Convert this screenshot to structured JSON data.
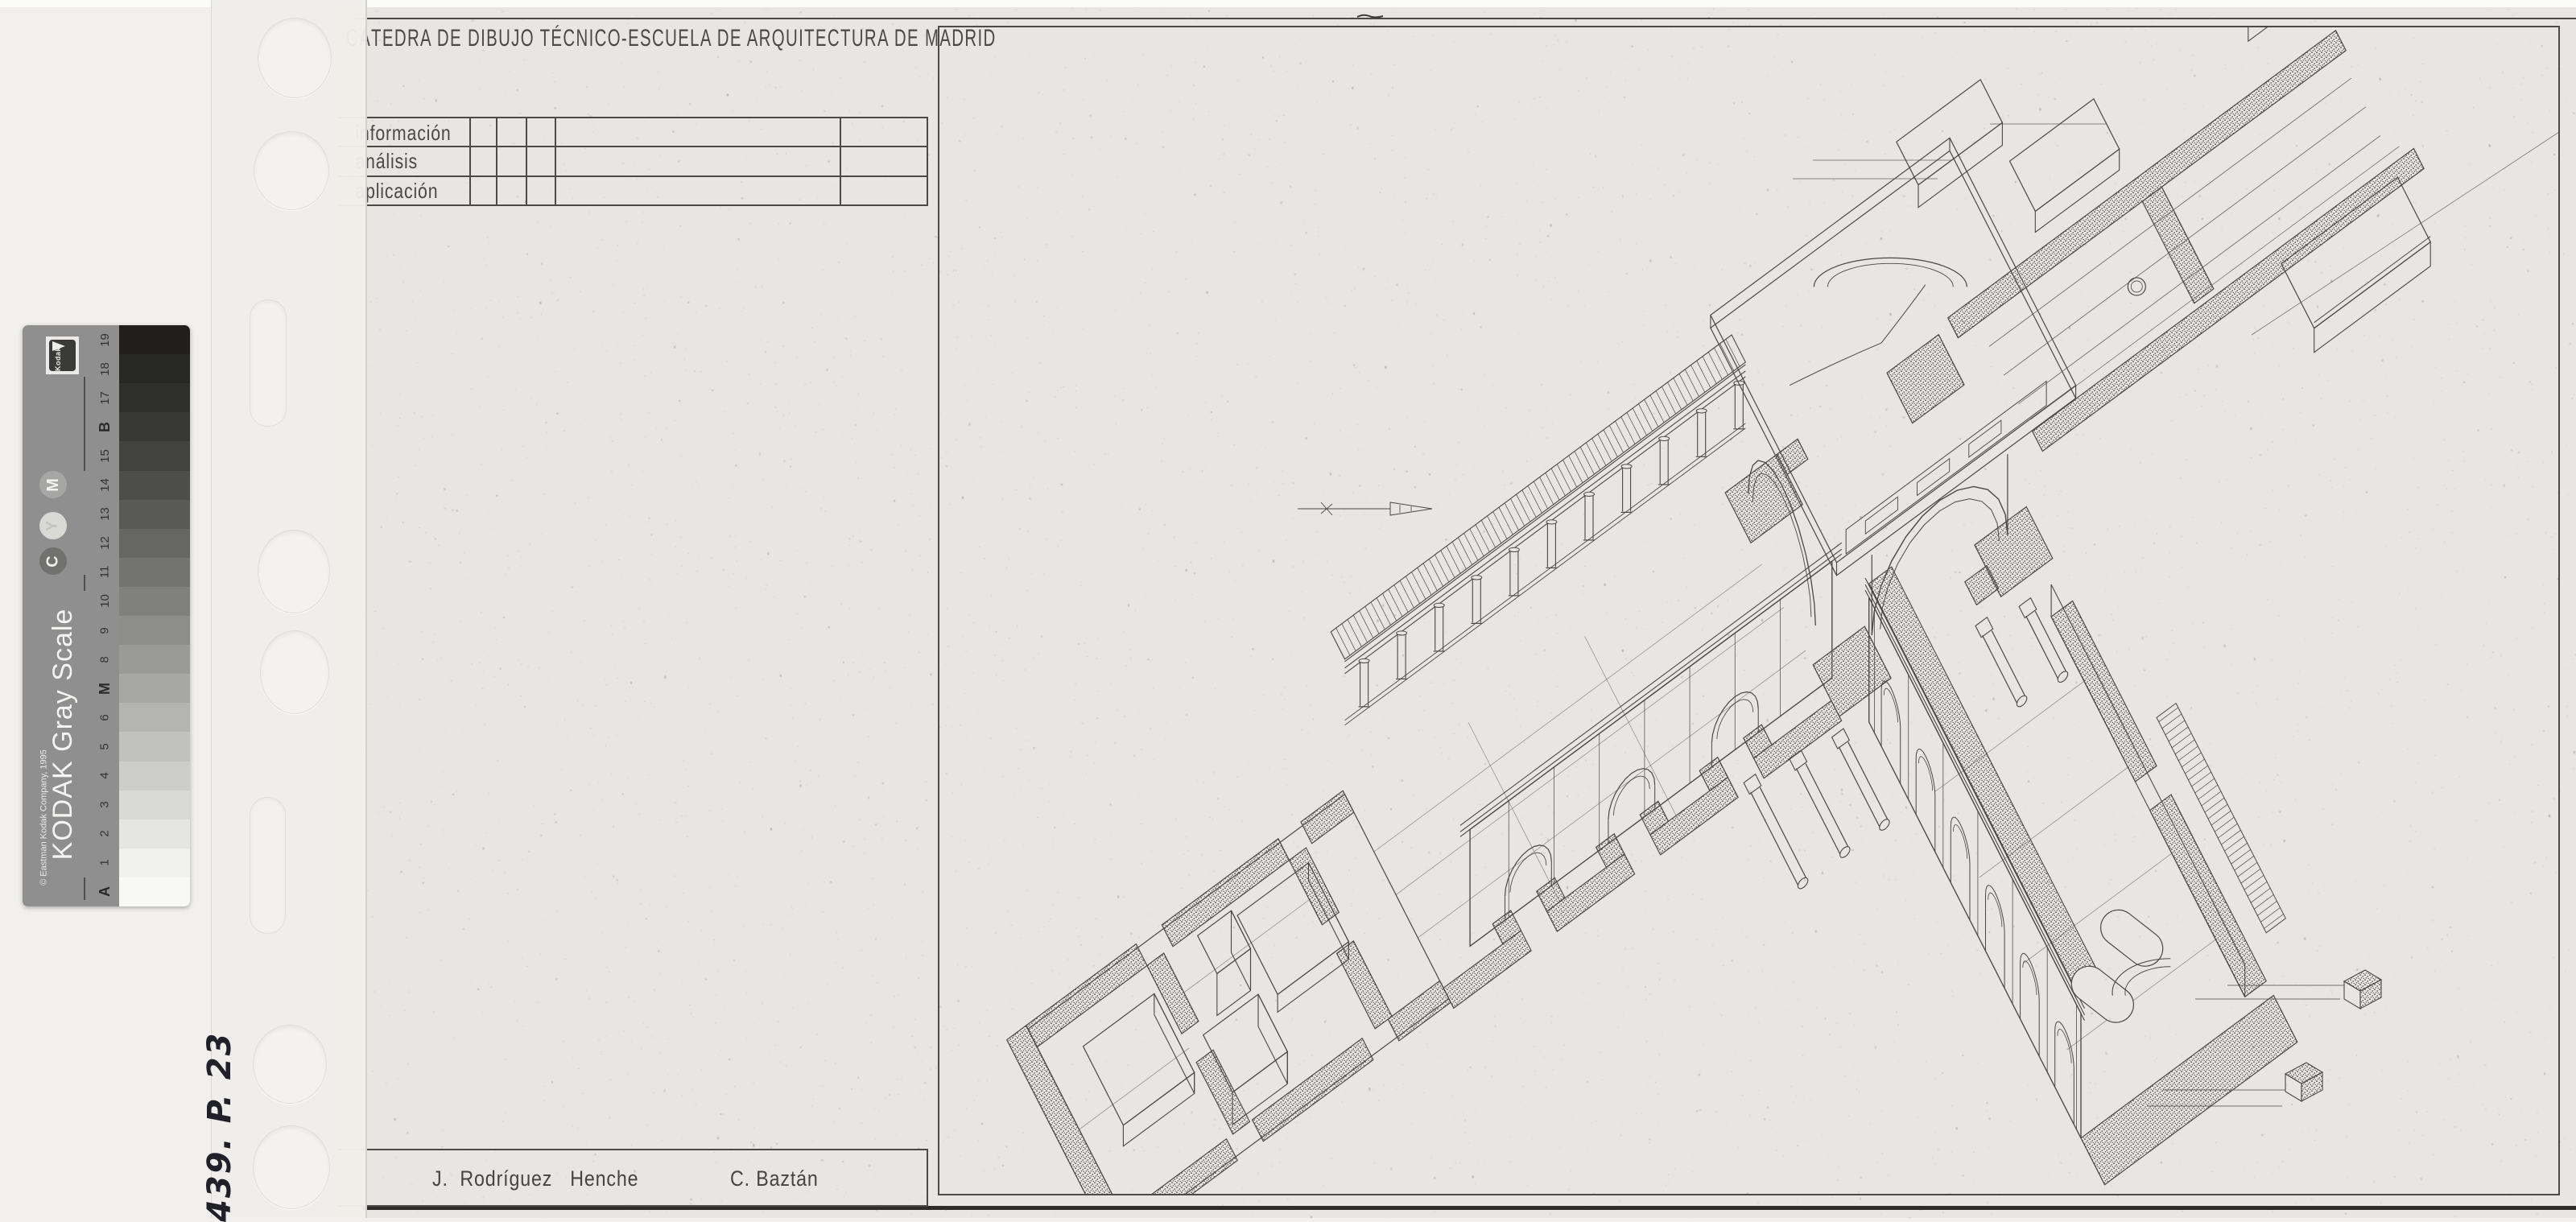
{
  "sheet": {
    "header_title": "CÁTEDRA DE DIBUJO TÉCNICO-ESCUELA DE ARQUITECTURA DE MADRID",
    "table": {
      "rows": [
        {
          "label": "información"
        },
        {
          "label": "análisis"
        },
        {
          "label": "aplicación"
        }
      ]
    },
    "authors": {
      "author1": "J.  Rodríguez   Henche",
      "author2": "C. Baztán"
    },
    "drawing": {
      "alt": "Sectioned axonometric ink drawing of a cruciform church: plan cut with stippled walls, nave running to upper right, transept to lower right, colonnade and cornice fragments"
    }
  },
  "gray_scale": {
    "brand_title": "KODAK Gray Scale",
    "copyright": "© Eastman Kodak Company, 1995",
    "logo_text": "Kodak",
    "circles": {
      "c": "C",
      "y": "Y",
      "m": "M"
    },
    "steps": [
      {
        "label": "19",
        "bold": false,
        "color": "#201f1e"
      },
      {
        "label": "18",
        "bold": false,
        "color": "#272726"
      },
      {
        "label": "17",
        "bold": false,
        "color": "#2f2f2e"
      },
      {
        "label": "B",
        "bold": true,
        "color": "#383837"
      },
      {
        "label": "15",
        "bold": false,
        "color": "#424241"
      },
      {
        "label": "14",
        "bold": false,
        "color": "#4d4d4c"
      },
      {
        "label": "13",
        "bold": false,
        "color": "#595958"
      },
      {
        "label": "12",
        "bold": false,
        "color": "#666665"
      },
      {
        "label": "11",
        "bold": false,
        "color": "#737372"
      },
      {
        "label": "10",
        "bold": false,
        "color": "#80807f"
      },
      {
        "label": "9",
        "bold": false,
        "color": "#8d8d8c"
      },
      {
        "label": "8",
        "bold": false,
        "color": "#9a9a99"
      },
      {
        "label": "M",
        "bold": true,
        "color": "#a7a7a6"
      },
      {
        "label": "6",
        "bold": false,
        "color": "#b4b4b3"
      },
      {
        "label": "5",
        "bold": false,
        "color": "#c1c1c0"
      },
      {
        "label": "4",
        "bold": false,
        "color": "#cdcdcc"
      },
      {
        "label": "3",
        "bold": false,
        "color": "#d9d9d8"
      },
      {
        "label": "2",
        "bold": false,
        "color": "#e5e5e4"
      },
      {
        "label": "1",
        "bold": false,
        "color": "#f0f0ef"
      },
      {
        "label": "A",
        "bold": true,
        "color": "#f8f8f7"
      }
    ]
  },
  "handwritten_note": "439. P. 23",
  "colors": {
    "paper": "#e7e6e2",
    "ink": "#4a4845",
    "scan_bed": "#f1f0ee"
  }
}
